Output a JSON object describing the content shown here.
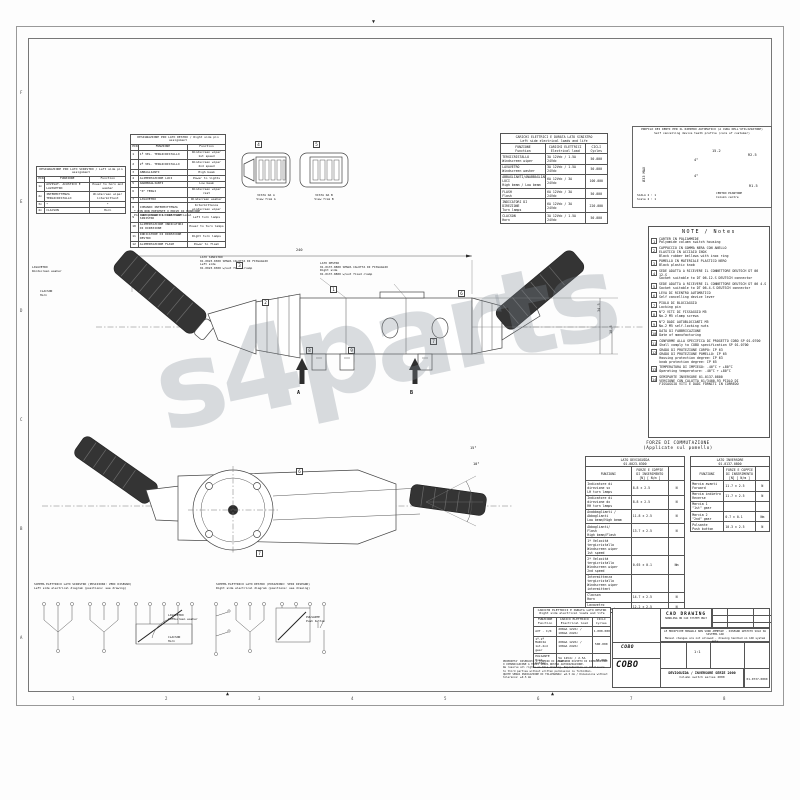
{
  "watermark": "s4parts",
  "frame": {
    "bottom_zones": [
      "1",
      "2",
      "3",
      "4",
      "5",
      "6",
      "7",
      "8"
    ],
    "side_zones": [
      "F",
      "E",
      "D",
      "C",
      "B",
      "A"
    ]
  },
  "pin_tables": {
    "left": {
      "title": "DESIGNAZIONE PIN LATO SINISTRO / Left side pin assignment",
      "headers": [
        "PIN",
        "FUNZIONE",
        "Function"
      ],
      "rows": [
        [
          "1x",
          "AVVISAT. ACUSTICO E LAVAVETRO",
          "Power to horn and washer"
        ],
        [
          "2x",
          "INTERMITTENZA TERGICRISTALLO",
          "Windscreen wiper intermittent"
        ],
        [
          "3x",
          "*",
          "*"
        ],
        [
          "4x",
          "CLACSON",
          "Horn"
        ]
      ]
    },
    "right": {
      "title": "DESIGNAZIONE PIN LATO DESTRO / Right side pin assignment",
      "headers": [
        "PIN",
        "FUNZIONE",
        "Function"
      ],
      "rows": [
        [
          "1",
          "1ª VEL. TERGICRISTALLO",
          "Windscreen wiper 1st speed"
        ],
        [
          "2",
          "2ª VEL. TERGICRISTALLO",
          "Windscreen wiper 2nd speed"
        ],
        [
          "3",
          "ABBAGLIANTI",
          "High beam"
        ],
        [
          "4",
          "ALIMENTAZIONE LUCI",
          "Power to lights"
        ],
        [
          "5",
          "ANABBAGLIANTI",
          "Low beam"
        ],
        [
          "6",
          "\"0\" TERGI",
          "Windscreen wiper rest"
        ],
        [
          "7",
          "LAVAVETRO",
          "Windscreen washer"
        ],
        [
          "8",
          "COMANDO INTERMITTENZA",
          "Intermittence windscreen wiper"
        ],
        [
          "9",
          "INDICATORE DI DIREZIONE SINISTRO",
          "Left turn lamps"
        ],
        [
          "10",
          "ALIMENTAZIONE INDICATORI DI DIREZIONE",
          "Power to turn lamps"
        ],
        [
          "11",
          "INDICATORE DI DIREZIONE DESTRO",
          "Right turn lamps"
        ],
        [
          "12",
          "ALIMENTAZIONE FLASH",
          "Power to flash"
        ]
      ]
    },
    "footnote": "* PIN NON PRESENTE O PRIVO DI FUNZIONE\nPin not present or not functional"
  },
  "connector_views": {
    "view_a_label": "VISTA DA A\nView from A",
    "view_b_label": "VISTA DA B\nView from B"
  },
  "loads_left": {
    "title": "CARICHI ELETTRICI E DURATA LATO SINISTRO\nLeft side electrical loads and life",
    "headers": [
      "FUNZIONE\nFunction",
      "CARICHI ELETTRICI\nElectrical load",
      "CICLI\nCycles"
    ],
    "rows": [
      [
        "TERGICRISTALLO\nWindscreen wiper",
        "3A 12Vdc / 1.5A 24Vdc",
        "50.000"
      ],
      [
        "LAVAVETRO\nWindscreen washer",
        "3A 12Vdc / 1.5A 24Vdc",
        "50.000"
      ],
      [
        "ABBAGLIANTI/ANABBAGLIANTI LUCI\nHigh beam / Low beam",
        "6A 12Vdc / 3A 24Vdc",
        "100.000"
      ],
      [
        "FLASH\nFlash",
        "6A 12Vdc / 3A 24Vdc",
        "50.000"
      ],
      [
        "INDICATORI DI DIREZIONE\nTurn lamps",
        "6A 12Vdc / 3A 24Vdc",
        "220.000"
      ],
      [
        "CLACSON\nHorn",
        "3A 12Vdc / 1.5A 24Vdc",
        "50.000"
      ]
    ]
  },
  "profile": {
    "title": "PROFILO DEI DENTI PER IL RIENTRO AUTOMATICO (A CURA DELL'UTILIZZATORE)\nSelf cancelling device teeth profile (care of customer)",
    "dim_width": "15.2",
    "dim_diameter": "Ø33 MAX",
    "angle_top": "4°",
    "angle_bottom": "4°",
    "radius_outer": "R2.5",
    "radius_inner": "R1.5",
    "center_label": "CENTRO PIANTONE\nColumn centre",
    "scale": "SCALA 2 : 1\nScale 2 : 1"
  },
  "notes": {
    "title": "NOTE / Notes",
    "items": [
      {
        "n": "1",
        "it": "CARTER IN POLIAMMIDE",
        "en": "Polyamide column switch housing"
      },
      {
        "n": "2",
        "it": "CAPPUCCIO IN GOMMA NERA CON ANELLO\nELASTICO IN ACCIAIO INOX",
        "en": "Black rubber bellows with inox ring"
      },
      {
        "n": "3",
        "it": "POMELLO IN MATERIALE PLASTICO NERO",
        "en": "Black plastic knob"
      },
      {
        "n": "4",
        "it": "SEDE ADATTA A RICEVERE IL CONNETTORE DEUTSCH DT 06 12.S",
        "en": "Socket suitable to DT 06-12.S DEUTSCH connector"
      },
      {
        "n": "5",
        "it": "SEDE ADATTA A RICEVERE IL CONNETTORE DEUTSCH DT 06 4.S",
        "en": "Socket suitable to DT 06-4.S DEUTSCH connector"
      },
      {
        "n": "6",
        "it": "LEVA DI RIENTRO AUTOMATICO",
        "en": "Self cancelling device lever"
      },
      {
        "n": "7",
        "it": "PIOLO DI BLOCCAGGIO",
        "en": "Locking pin"
      },
      {
        "n": "8",
        "it": "N°2 VITI DI FISSAGGIO M5",
        "en": "No.2 M5 clamp screws"
      },
      {
        "n": "9",
        "it": "N°2 DADI AUTOBLOCCANTI M5",
        "en": "No.2 M5 self-locking nuts"
      },
      {
        "n": "10",
        "it": "DATA DI FABBRICAZIONE",
        "en": "Date of manufacturing"
      },
      {
        "n": "11",
        "it": "CONFORME ALLA SPECIFICA DI PROGETTO COBO SP 01.0700",
        "en": "Shall comply to COBO specification SP 01.0700"
      },
      {
        "n": "12",
        "it": "GRADO DI PROTEZIONE CORPO: IP 63\nGRADO DI PROTEZIONE POMELLO: IP 65",
        "en": "Housing protection degree: IP 63\nknob protection degree: IP 65"
      },
      {
        "n": "13",
        "it": "TEMPERATURA DI IMPIEGO: -40°C ÷ +80°C",
        "en": "Operating temperature: -40°C ÷ +80°C"
      },
      {
        "n": "14",
        "it": "SEMIPARTE INVERSORE 01-0137-0800\nVERSIONE CON CALOTTA 01/3400-93 PIOLO DI\nFISSAGGIO VITI E DADI FORNITI IN CORREDO",
        "en": ""
      }
    ]
  },
  "forces": {
    "title": "FORZE DI COMMUTAZIONE",
    "subtitle": "(Applicate sul pomello)",
    "left": {
      "title": "LATO DEVIOGUIDA\n01.0023.0300",
      "headers": [
        "FUNZIONI",
        "FORZE E COPPIE\nDI INSERIMENTO\n[N] [ N/m ]",
        ""
      ],
      "rows": [
        [
          "Indicatore di\ndirezione sx\nLH turn lamps",
          "8.8 ± 2.5",
          "N"
        ],
        [
          "Indicatore di\ndirezione dx\nRH turn lamps",
          "8.8 ± 2.5",
          "N"
        ],
        [
          "Anabbaglianti /\nAbbaglianti\nLow beam/High beam",
          "11.8 ± 2.5",
          "N"
        ],
        [
          "Abbaglianti/\nFlash\nHigh beam/Flash",
          "13.7 ± 2.5",
          "N"
        ],
        [
          "1ª Velocità\ntergicristallo\nWindscreen wiper\n1st speed",
          "",
          ""
        ],
        [
          "2ª Velocità\ntergicristallo\nWindscreen wiper\n2nd speed",
          "0.65 ± 0.1",
          "Nm"
        ],
        [
          "Intermittenza\ntergicristallo\nWindscreen wiper\nintermittent",
          "",
          ""
        ],
        [
          "Clacson\nHorn",
          "14.7 ± 2.5",
          "N"
        ],
        [
          "Lavavetro\nWindscreen washer",
          "12.2 ± 2.5",
          "N"
        ]
      ]
    },
    "right": {
      "title": "LATO INVERSORE\n01.0137.0800",
      "headers": [
        "FUNZIONI",
        "FORZE E COPPIE\nDI INSERIMENTO\n[N] [ N/m ]",
        ""
      ],
      "rows": [
        [
          "Marcia avanti\nForward",
          "11.7 ± 2.5",
          "N"
        ],
        [
          "Marcia indietro\nReverse",
          "11.7 ± 2.5",
          "N"
        ],
        [
          "Marcia 1\n\"1st\" gear",
          "",
          ""
        ],
        [
          "Marcia 2\n\"2nd\" gear",
          "0.7 ± 0.1",
          "Nm"
        ],
        [
          "Pulsante\nPush button",
          "10.3 ± 2.5",
          "N"
        ]
      ]
    }
  },
  "drawing_top": {
    "dim_total": "240",
    "dim_h1": "34.5",
    "dim_h2": "18.5",
    "label_left_side": "LATO SINISTRO\n01.0023.0300 SENZA CALOTTA DI FISSAGGIO\nLeft side\n01.0023.0300 w/out fixed clamp",
    "label_right_side": "LATO DESTRO\n01.0137.0800 SENZA CALOTTA DI FISSAGGIO\nRight side\n01.0137.0800 w/out fixed clamp",
    "label_washer": "LAVAVETRO\nWindscreen washer",
    "label_horn": "CLACSON\nHorn",
    "arrow_a": "A",
    "arrow_b": "B"
  },
  "drawing_bottom": {
    "angle1": "15°",
    "angle2": "10°"
  },
  "balloons": {
    "b1": "1",
    "b2": "2",
    "b3": "3",
    "b4": "4",
    "b5": "5",
    "b6": "6",
    "b7": "7",
    "b8": "8",
    "b9": "9"
  },
  "schematics": {
    "title_left": "SCHEMA ELETTRICO LATO SINISTRO (POSIZIONI: VEDI DISEGNO)\nLeft side electrical diagram (positions: see drawing)",
    "title_right": "SCHEMA ELETTRICO LATO DESTRO (POSIZIONI: VEDI DISEGNO)\nRight side electrical diagram (positions: see drawing)",
    "label_washer": "LAVAVETRO\nWindscreen washer",
    "label_horn": "CLACSON\nHorn",
    "label_button": "PULSANTE\nPush button"
  },
  "loads_right": {
    "title": "CARICHI ELETTRICI E DURATA LATO DESTRO\nRight side electrical loads and life",
    "headers": [
      "FUNZIONE\nFunction",
      "CARICO ELETTRICO\nElectrical load",
      "CICLI\nCycles"
    ],
    "rows": [
      [
        "AVT - I/R",
        "200mA 12Vdc / 100mA 24Vdc",
        "1.000.000"
      ],
      [
        "1ª-2ª MARCIA\n1st-2nd gear",
        "200mA 12Vdc / 100mA 24Vdc",
        "500.000"
      ],
      [
        "PULSANTE\nPush button",
        "5A 12Vdc / 2.5A 24Vdc",
        "50.000"
      ]
    ]
  },
  "fine_print": "PROPRIETA' RISERVATA A TERMINI DI LEGGE CON DIVIETO DI RIPRODUZIONE O COMUNICAZIONE A TERZI SENZA NOSTRA AUTORIZZAZIONE.\nWe reserve all rights on this drawing. Reproduction or disclosure to third parties without written permission is forbidden.\nQUOTE SENZA INDICAZIONE DI TOLLERANZA: ±0.5 mm / Dimensions without tolerance: ±0.5 mm",
  "title_block": {
    "cad": "CAD DRAWING",
    "cad_sub": "HANDLING ON CAD SYSTEM ONLY",
    "notice": "LE MODIFICHE MANUALI NON SONO AMMESSE - DISEGNO GESTITO SOLO SU SISTEMA CAD\nManual changes are not allowed - drawing handled on CAD system only",
    "brand_small": "COBO",
    "brand_big": "COBO",
    "scale": "1:1",
    "title_it": "DEVIOGUIDA / INVERSORE SERIE 2000",
    "title_en": "Column switch series 2000",
    "number": "01-0737-0800"
  }
}
